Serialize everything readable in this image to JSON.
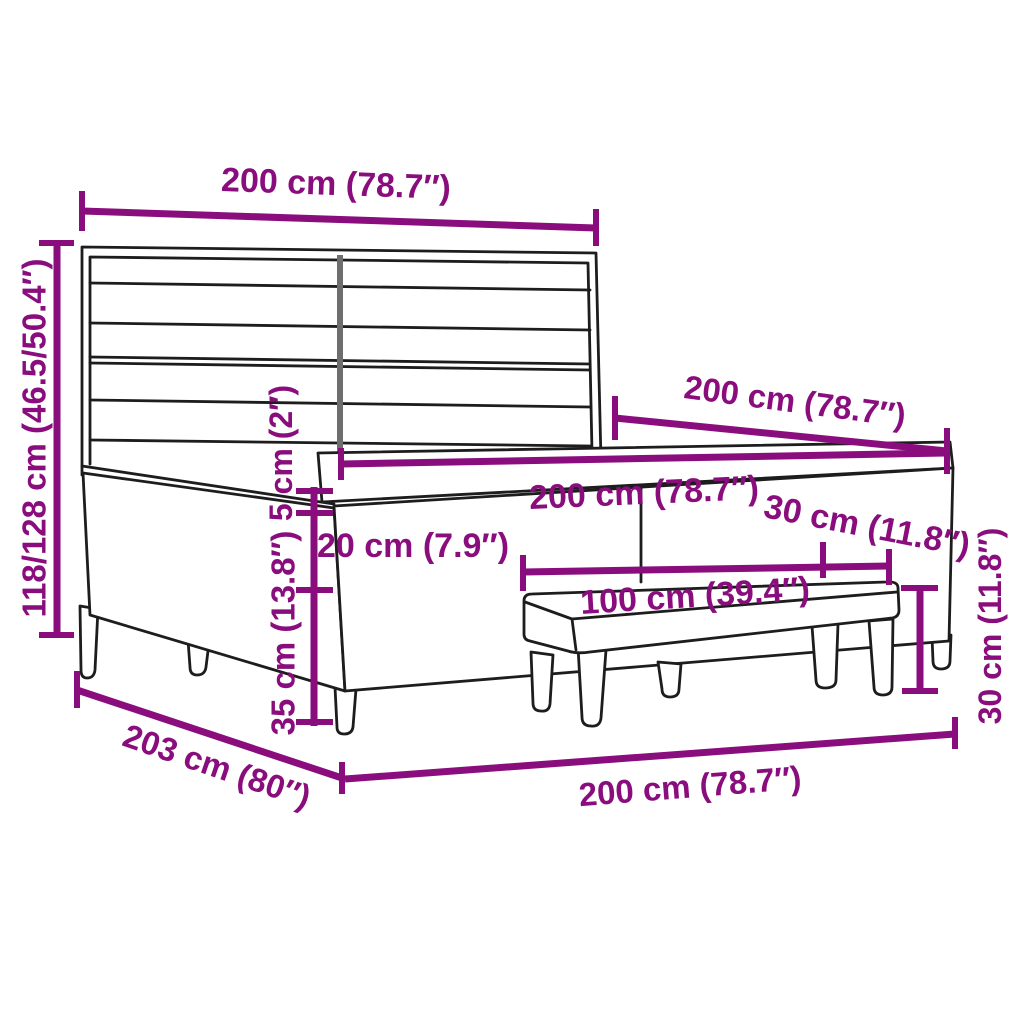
{
  "diagram": {
    "kind": "product-dimension-diagram",
    "subject": "box spring bed with striped headboard, mattress, topper and bench",
    "background": "#ffffff",
    "accent_color": "#8a0d7d",
    "line_color": "#1d1d1d",
    "seam_color": "#6e6e6e"
  },
  "dimensions": {
    "headboard_width": "200 cm (78.7″)",
    "total_height": "118/128 cm (46.5/50.4″)",
    "bed_length": "200 cm (78.7″)",
    "mattress_width": "200 cm (78.7″)",
    "topper_height": "5 cm (2″)",
    "mattress_height": "20 cm (7.9″)",
    "base_height": "35 cm (13.8″)",
    "bench_length": "100 cm (39.4″)",
    "bench_depth": "30 cm (11.8″)",
    "bench_height": "30 cm (11.8″)",
    "frame_length": "203 cm (80″)",
    "frame_width": "200 cm (78.7″)"
  }
}
